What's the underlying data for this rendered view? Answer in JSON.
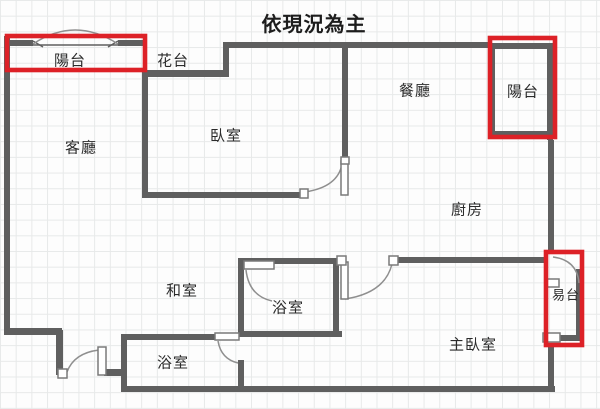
{
  "title": "依現況為主",
  "canvas": {
    "width": 600,
    "height": 409
  },
  "colors": {
    "background": "#fdfdfd",
    "grid_line": "#e7e9e9",
    "wall": "#5f5f5f",
    "door_arc": "#8f8f8f",
    "leaf_fill": "#ffffff",
    "leaf_stroke": "#7a7a7a",
    "highlight_red": "#dd2127",
    "label_text": "#2b2b2b",
    "title_text": "#1d1d1d"
  },
  "labels": [
    {
      "name": "balcony-top-left",
      "text": "陽台",
      "x": 70,
      "y": 60,
      "size": 15
    },
    {
      "name": "flower-bed",
      "text": "花台",
      "x": 173,
      "y": 60,
      "size": 15
    },
    {
      "name": "living-room",
      "text": "客廳",
      "x": 81,
      "y": 147,
      "size": 15
    },
    {
      "name": "bedroom",
      "text": "臥室",
      "x": 226,
      "y": 135,
      "size": 15
    },
    {
      "name": "dining-room",
      "text": "餐廳",
      "x": 415,
      "y": 90,
      "size": 15
    },
    {
      "name": "balcony-top-right",
      "text": "陽台",
      "x": 523,
      "y": 91,
      "size": 15
    },
    {
      "name": "kitchen",
      "text": "廚房",
      "x": 467,
      "y": 209,
      "size": 15
    },
    {
      "name": "tatami-room",
      "text": "和室",
      "x": 182,
      "y": 290,
      "size": 15
    },
    {
      "name": "bathroom-middle",
      "text": "浴室",
      "x": 288,
      "y": 307,
      "size": 15
    },
    {
      "name": "bathroom-bottom",
      "text": "浴室",
      "x": 173,
      "y": 362,
      "size": 15
    },
    {
      "name": "master-bedroom",
      "text": "主臥室",
      "x": 473,
      "y": 344,
      "size": 15
    },
    {
      "name": "balcony-rear",
      "text": "易台",
      "x": 566,
      "y": 295,
      "size": 13
    }
  ],
  "walls": [
    {
      "name": "outer-wall-left",
      "x": 4,
      "y": 36,
      "w": 6,
      "h": 296
    },
    {
      "name": "outer-wall-bottom-left-step-h",
      "x": 4,
      "y": 328,
      "w": 58,
      "h": 7
    },
    {
      "name": "outer-wall-bottom-left-step-v",
      "x": 56,
      "y": 330,
      "w": 7,
      "h": 45
    },
    {
      "name": "entry-wall-stub",
      "x": 104,
      "y": 369,
      "w": 20,
      "h": 7
    },
    {
      "name": "bath-bottom-left-wall",
      "x": 121,
      "y": 335,
      "w": 6,
      "h": 57
    },
    {
      "name": "outer-wall-bottom",
      "x": 121,
      "y": 386,
      "w": 434,
      "h": 6
    },
    {
      "name": "bath-bottom-top-wall",
      "x": 121,
      "y": 334,
      "w": 97,
      "h": 6
    },
    {
      "name": "bath-bottom-right-wall",
      "x": 238,
      "y": 360,
      "w": 6,
      "h": 32
    },
    {
      "name": "bath-middle-left-wall",
      "x": 238,
      "y": 258,
      "w": 6,
      "h": 79
    },
    {
      "name": "bath-middle-top-wall",
      "x": 238,
      "y": 258,
      "w": 100,
      "h": 6
    },
    {
      "name": "bath-middle-right-wall",
      "x": 333,
      "y": 258,
      "w": 6,
      "h": 79
    },
    {
      "name": "bath-middle-bottom-wall",
      "x": 238,
      "y": 331,
      "w": 104,
      "h": 6
    },
    {
      "name": "kitchen-master-wall",
      "x": 395,
      "y": 257,
      "w": 153,
      "h": 6
    },
    {
      "name": "outer-wall-right-upper",
      "x": 548,
      "y": 140,
      "w": 6,
      "h": 112
    },
    {
      "name": "outer-wall-right-lower",
      "x": 548,
      "y": 347,
      "w": 6,
      "h": 45
    },
    {
      "name": "outer-wall-top",
      "x": 223,
      "y": 42,
      "w": 268,
      "h": 6
    },
    {
      "name": "balcony-tr-top-wall",
      "x": 490,
      "y": 43,
      "w": 63,
      "h": 6
    },
    {
      "name": "balcony-tr-left-wall",
      "x": 490,
      "y": 43,
      "w": 5,
      "h": 94
    },
    {
      "name": "balcony-tr-bottom-wall",
      "x": 490,
      "y": 131,
      "w": 63,
      "h": 6
    },
    {
      "name": "balcony-tr-right-wall",
      "x": 547,
      "y": 43,
      "w": 6,
      "h": 97
    },
    {
      "name": "flower-bed-wall",
      "x": 145,
      "y": 70,
      "w": 84,
      "h": 7
    },
    {
      "name": "flower-bed-step-wall",
      "x": 223,
      "y": 42,
      "w": 6,
      "h": 35
    },
    {
      "name": "living-bedroom-divider",
      "x": 142,
      "y": 70,
      "w": 6,
      "h": 128
    },
    {
      "name": "bedroom-bottom-wall",
      "x": 142,
      "y": 192,
      "w": 163,
      "h": 6
    },
    {
      "name": "bedroom-dining-divider",
      "x": 342,
      "y": 42,
      "w": 6,
      "h": 119
    },
    {
      "name": "balcony-tl-wall-left",
      "x": 9,
      "y": 40,
      "w": 24,
      "h": 6
    },
    {
      "name": "balcony-tl-wall-right",
      "x": 118,
      "y": 40,
      "w": 27,
      "h": 6
    },
    {
      "name": "balcony-rear-right-wall",
      "x": 576,
      "y": 269,
      "w": 6,
      "h": 72
    },
    {
      "name": "balcony-rear-bottom-wall",
      "x": 549,
      "y": 335,
      "w": 33,
      "h": 6
    }
  ],
  "thin_lines": [
    {
      "name": "bay-window-sill",
      "x1": 33,
      "y1": 45,
      "x2": 118,
      "y2": 45
    },
    {
      "name": "bay-window-tick-left",
      "x1": 33,
      "y1": 41,
      "x2": 43,
      "y2": 47
    },
    {
      "name": "bay-window-tick-right",
      "x1": 118,
      "y1": 41,
      "x2": 108,
      "y2": 47
    }
  ],
  "door_arcs": [
    {
      "name": "bay-window-arc",
      "d": "M33,44 Q75,16 118,44"
    },
    {
      "name": "bedroom-door-arc",
      "d": "M305,192 Q338,187 342,164"
    },
    {
      "name": "hall-door-arc",
      "d": "M345,299 Q385,293 392,264"
    },
    {
      "name": "bath-middle-door-arc",
      "d": "M246,270 Q249,296 272,301"
    },
    {
      "name": "bath-bottom-door-arc",
      "d": "M218,341 Q221,359 238,363"
    },
    {
      "name": "entry-door-arc",
      "d": "M67,372 Q74,353 99,350"
    },
    {
      "name": "balcony-rear-door-arc",
      "d": "M553,257 Q577,260 579,283"
    }
  ],
  "door_leaves": [
    {
      "name": "bedroom-door-leaf",
      "x": 341,
      "y": 161,
      "w": 7,
      "h": 34
    },
    {
      "name": "hall-door-leaf",
      "x": 341,
      "y": 262,
      "w": 7,
      "h": 37
    },
    {
      "name": "bath-middle-door-leaf",
      "x": 244,
      "y": 261,
      "w": 30,
      "h": 8
    },
    {
      "name": "bath-bottom-door-leaf",
      "x": 215,
      "y": 333,
      "w": 24,
      "h": 7
    },
    {
      "name": "entry-door-leaf",
      "x": 98,
      "y": 347,
      "w": 8,
      "h": 28
    }
  ],
  "jambs": [
    {
      "name": "bedroom-door-jamb",
      "x": 300,
      "y": 189,
      "w": 8,
      "h": 9
    },
    {
      "name": "bedroom-door-top-jamb",
      "x": 341,
      "y": 157,
      "w": 8,
      "h": 7
    },
    {
      "name": "hall-door-jamb-left",
      "x": 337,
      "y": 256,
      "w": 9,
      "h": 9
    },
    {
      "name": "hall-door-jamb-right",
      "x": 389,
      "y": 256,
      "w": 9,
      "h": 9
    },
    {
      "name": "entry-door-jamb",
      "x": 58,
      "y": 369,
      "w": 9,
      "h": 9
    },
    {
      "name": "balcony-rear-window-upper",
      "x": 545,
      "y": 279,
      "w": 14,
      "h": 8
    },
    {
      "name": "balcony-rear-window-lower",
      "x": 543,
      "y": 333,
      "w": 17,
      "h": 9
    }
  ],
  "highlights": [
    {
      "name": "highlight-balcony-top-left",
      "x": 7,
      "y": 36,
      "w": 138,
      "h": 34
    },
    {
      "name": "highlight-balcony-top-right",
      "x": 490,
      "y": 38,
      "w": 65,
      "h": 99
    },
    {
      "name": "highlight-balcony-rear",
      "x": 546,
      "y": 252,
      "w": 36,
      "h": 93
    }
  ]
}
